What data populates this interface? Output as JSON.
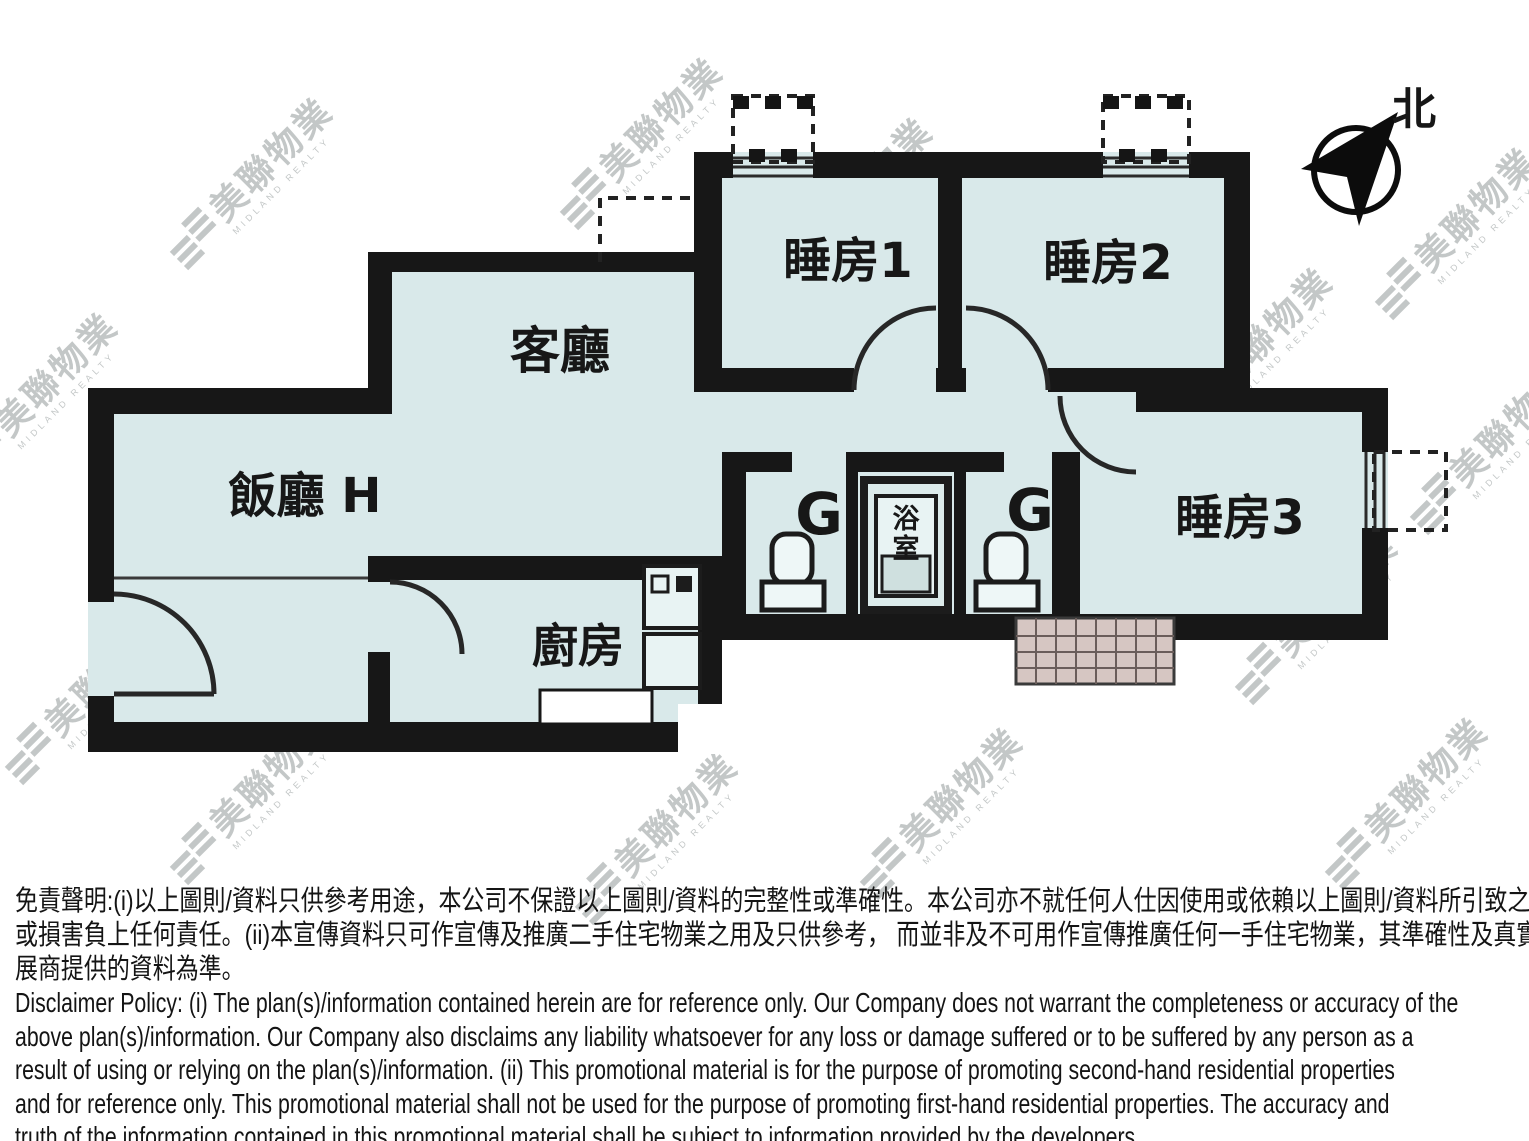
{
  "compass": {
    "north_label": "北"
  },
  "rooms": {
    "living": "客廳",
    "dining": "飯廳 H",
    "kitchen": "廚房",
    "bedroom1": "睡房1",
    "bedroom2": "睡房2",
    "bedroom3": "睡房3",
    "bath_char1": "浴",
    "bath_char2": "室",
    "toilet_mark_left": "G",
    "toilet_mark_right": "G"
  },
  "watermark": {
    "cjk": "美聯物業",
    "en": "MIDLAND REALTY",
    "positions": [
      [
        40,
        400
      ],
      [
        255,
        185
      ],
      [
        90,
        700
      ],
      [
        255,
        800
      ],
      [
        390,
        455
      ],
      [
        475,
        635
      ],
      [
        645,
        145
      ],
      [
        620,
        655
      ],
      [
        660,
        840
      ],
      [
        855,
        205
      ],
      [
        830,
        550
      ],
      [
        960,
        390
      ],
      [
        945,
        815
      ],
      [
        1125,
        240
      ],
      [
        1105,
        480
      ],
      [
        1255,
        355
      ],
      [
        1320,
        620
      ],
      [
        1460,
        235
      ],
      [
        1495,
        450
      ],
      [
        1410,
        805
      ]
    ]
  },
  "colors": {
    "floor": "#d9e9ea",
    "wall": "#171717",
    "watermark": "rgba(104,116,116,0.40)",
    "platform_hatch": "#d6c6c2"
  },
  "disclaimer": {
    "zh": [
      "免責聲明:(i)以上圖則/資料只供參考用途，本公司不保證以上圖則/資料的完整性或準確性。本公司亦不就任何人仕因使用或依賴以上圖則/資料所引致之任何損失",
      "或損害負上任何責任。(ii)本宣傳資料只可作宣傳及推廣二手住宅物業之用及只供參考， 而並非及不可用作宣傳推廣任何一手住宅物業，其準確性及真實性以樓盤發",
      "展商提供的資料為準。"
    ],
    "en": [
      "Disclaimer Policy: (i) The plan(s)/information contained herein are for reference only. Our Company does not warrant the completeness or accuracy of the",
      "above plan(s)/information. Our Company also disclaims any liability whatsoever for any loss or damage suffered or to be suffered by any person as a",
      "result of using or relying on the plan(s)/information. (ii) This promotional material is for the purpose of promoting second-hand residential properties",
      "and for reference only. This promotional material shall not be used for the purpose of promoting first-hand residential properties. The accuracy and",
      "truth of the information contained in this promotional material shall be subject to information provided by the developers."
    ]
  }
}
